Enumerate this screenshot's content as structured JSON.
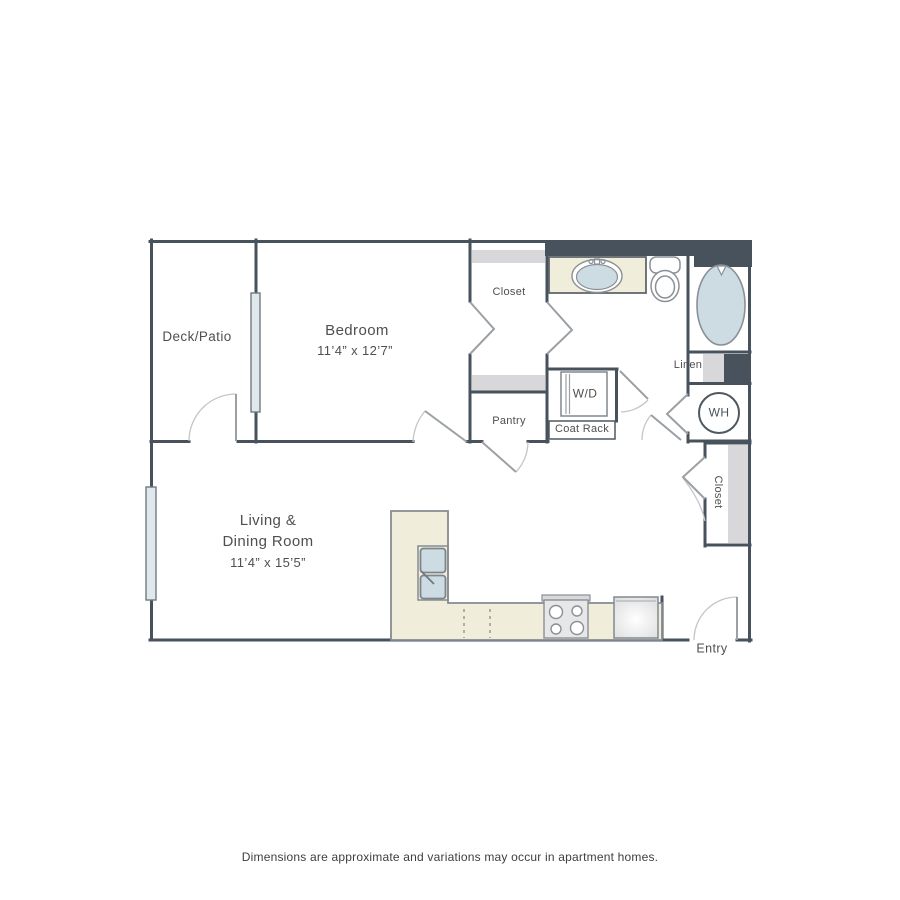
{
  "plan": {
    "rooms": {
      "deck_patio": {
        "label": "Deck/Patio"
      },
      "bedroom": {
        "label": "Bedroom",
        "dimensions": "11’4” x 12’7”"
      },
      "living_dining": {
        "label_line1": "Living &",
        "label_line2": "Dining Room",
        "dimensions": "11’4” x 15’5”"
      },
      "closet_bedroom": {
        "label": "Closet"
      },
      "pantry": {
        "label": "Pantry"
      },
      "washer_dryer": {
        "label": "W/D"
      },
      "coat_rack": {
        "label": "Coat Rack"
      },
      "linen": {
        "label": "Linen"
      },
      "water_heater": {
        "label": "WH"
      },
      "closet_entry": {
        "label": "Closet"
      },
      "entry": {
        "label": "Entry"
      }
    },
    "fixtures": [
      "bathtub",
      "toilet",
      "bathroom-sink",
      "kitchen-sink",
      "stove",
      "refrigerator",
      "washer-dryer",
      "water-heater"
    ],
    "colors": {
      "wall": "#47525d",
      "counter": "#f0edda",
      "shelf": "#d8d8da",
      "fixture_fill": "#cddce3",
      "window_fill": "#dfe9ec",
      "door_line": "#9aa0a4",
      "arc_line": "#c2c6c9",
      "text": "#4f4f4f"
    }
  },
  "footer": {
    "disclaimer": "Dimensions are approximate and variations may occur in apartment homes."
  }
}
